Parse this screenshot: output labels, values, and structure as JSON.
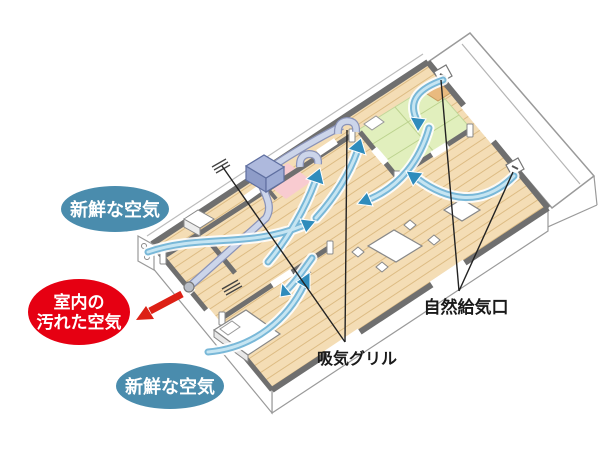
{
  "diagram": {
    "type": "ventilation-airflow-isometric-floorplan",
    "callouts": {
      "fresh_air_top": {
        "text": "新鮮な空気",
        "shape": "ellipse",
        "color": "#4a8cad",
        "text_color": "#ffffff"
      },
      "fresh_air_bottom": {
        "text": "新鮮な空気",
        "shape": "ellipse",
        "color": "#4a8cad",
        "text_color": "#ffffff"
      },
      "dirty_air": {
        "line1": "室内の",
        "line2": "汚れた空気",
        "shape": "ellipse",
        "color": "#e60012",
        "text_color": "#ffffff"
      },
      "intake_grill": {
        "text": "吸気グリル",
        "color": "#1a1a1a"
      },
      "natural_air_inlet": {
        "text": "自然給気口",
        "color": "#1a1a1a"
      }
    },
    "colors": {
      "label_blue": "#4a8cad",
      "label_red": "#e60012",
      "airflow_blue": "#2f8cbc",
      "airflow_body": "#79b8d8",
      "airflow_highlight": "#c6e5f2",
      "exhaust_red": "#dd2015",
      "wall_gray": "#6f6f6f",
      "floor_wood": "#f4ddb5",
      "plank_line": "#ddbc84",
      "tatami_green": "#e1efbd",
      "tatami_line": "#bdd38f",
      "closet_orange": "#e9ba7f",
      "room_pink": "#f8cbd0",
      "unit_lavender": "#aeb9dd",
      "duct_fill": "#ccd5ea",
      "duct_edge": "#8a93b8"
    }
  }
}
